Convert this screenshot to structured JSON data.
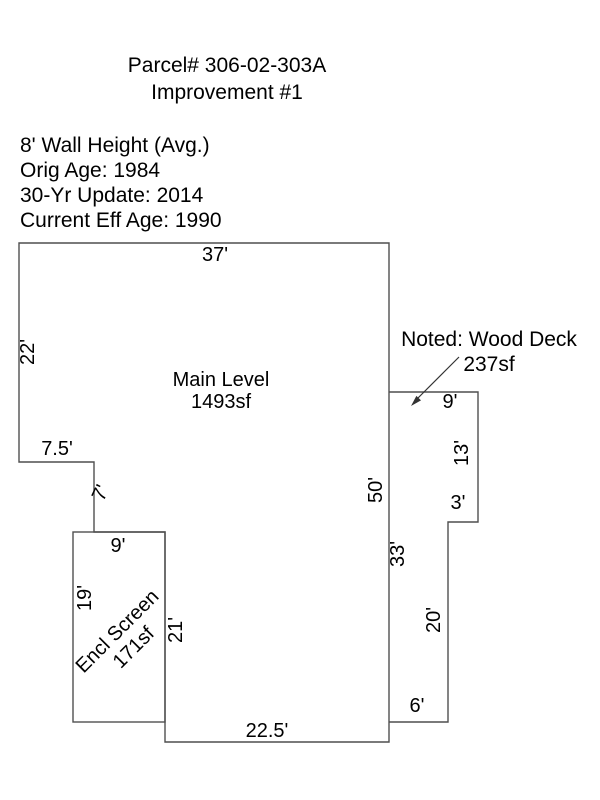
{
  "header": {
    "parcel_title": "Parcel# 306-02-303A",
    "improvement_subtitle": "Improvement #1"
  },
  "property_info": {
    "wall_height": "8' Wall Height (Avg.)",
    "orig_age": "Orig Age: 1984",
    "update_30yr": "30-Yr Update: 2014",
    "current_eff_age": "Current Eff Age: 1990"
  },
  "sketch": {
    "main_level": {
      "label": "Main Level",
      "area": "1493sf"
    },
    "encl_screen": {
      "label": "Encl Screen",
      "area": "171sf"
    },
    "wood_deck": {
      "note": "Noted: Wood Deck",
      "area": "237sf"
    },
    "dimensions": {
      "main_top": "37'",
      "main_left": "22'",
      "step_width": "7.5'",
      "step_down": "7'",
      "screen_top": "9'",
      "screen_left": "19'",
      "main_lower_left": "21'",
      "main_bottom": "22.5'",
      "main_right": "50'",
      "deck_left": "33'",
      "deck_top": "9'",
      "deck_right": "13'",
      "deck_step": "3'",
      "deck_lower_right": "20'",
      "deck_bottom": "6'"
    },
    "colors": {
      "wall": "#4f4f4f",
      "text": "#000000",
      "background": "#ffffff"
    }
  }
}
